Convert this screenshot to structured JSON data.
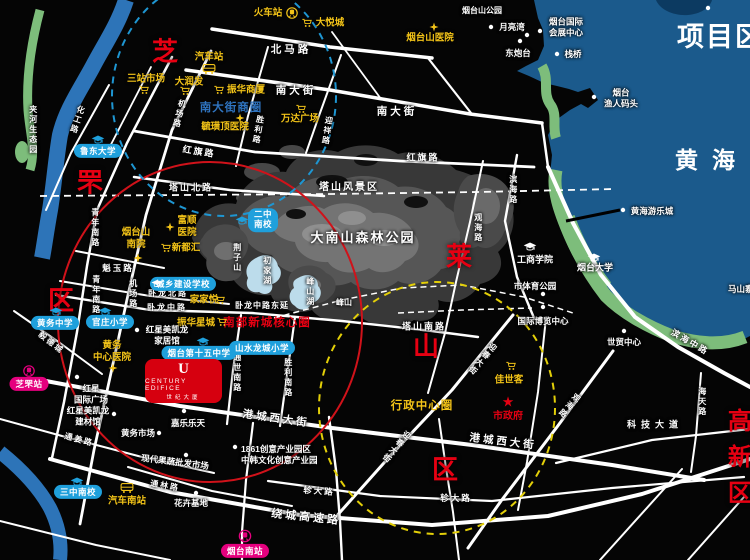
{
  "title": "项目区位",
  "sea_name": "黄海",
  "colors": {
    "sea": "#1b5a8c",
    "accent_red": "#e60012",
    "poi_yellow": "#f2c318",
    "school_blue": "#1fa0dc",
    "station_pink": "#e5007e"
  },
  "districts": {
    "zhi": "芝",
    "fu": "罘",
    "qu_zhifu": "区",
    "lai": "莱",
    "shan": "山",
    "qu_laishan": "区",
    "gaoxinqu": "高新区"
  },
  "zones": {
    "nandajie_shangquan": "南大街商圈",
    "nanbu_xincheng": "南部新城核心圈",
    "xingzheng_zhongxin": "行政中心圈"
  },
  "nature": {
    "jiahe": "夹河生态园",
    "tashan_scenic": "塔山风景区",
    "dananshan": "大南山森林公园",
    "yantaishan_park": "烟台山公园",
    "jingzishan": "荆子山",
    "fengshan": "峰山",
    "chujia_lake": "初家湖",
    "fengshan_lake": "峰山湖"
  },
  "roads": {
    "beimalu": "北马路",
    "nandajie": "南大街",
    "hongqilu": "红旗路",
    "tashanbeilu": "塔山北路",
    "tashannanlu": "塔山南路",
    "kuiyulu": "魁玉路",
    "wolongbeilu": "卧龙北路",
    "wolongzhonglu": "卧龙中路",
    "wolong_dongyan": "卧龙中路东延",
    "huagonglu": "化工路",
    "jichanglu": "机场路",
    "qingniannanlu": "青年南路",
    "shenglilu": "胜利路",
    "yingxianglu": "迎祥路",
    "tongshinanlu": "通世南路",
    "shenglinanlu": "胜利南路",
    "binhailu": "滨海路",
    "guanhailu": "观海路",
    "binhaizhonglu": "滨海中路",
    "haitianlu": "海天路",
    "kejidadao": "科技大道",
    "gangchengxidajie": "港城西大街",
    "raocheng": "绕城高速路",
    "zhendalu": "轸大路",
    "yingchundajie": "迎春大街",
    "tonglinlu": "通林路",
    "tongjianglu": "通姜路",
    "yidecheng": "毅德城"
  },
  "stations": {
    "huochezhan": "火车站",
    "qichezhan": "汽车站",
    "zhifuzhan": "芝罘站",
    "qichenanzhan": "汽车南站",
    "yantainanzhan": "烟台南站"
  },
  "pois": {
    "dayuecheng": "大悦城",
    "sanzhanshichang": "三站市场",
    "darunfa": "大润发",
    "zhenhuashangsha": "振华商厦",
    "wandaguangchang": "万达广场",
    "yuhuangding": "毓璜顶医院",
    "yantaishanyiyuan": "烟台山医院",
    "yueliangwan": "月亮湾",
    "dongpaotai": "东炮台",
    "huizhan1": "烟台国际",
    "huizhan2": "会展中心",
    "zhanqiao": "栈桥",
    "yuren1": "烟台",
    "yuren2": "渔人码头",
    "ludong": "鲁东大学",
    "fushun1": "富顺",
    "fushun2": "医院",
    "nanyuan1": "烟台山",
    "nanyuan2": "南院",
    "xinduhui": "新都汇",
    "erzhong1": "二中",
    "erzhong2": "南校",
    "chengxiang": "城乡建设学校",
    "jiajiayue": "家家悦",
    "zhenhuaxingcheng": "振华星城",
    "hongxing_jiaju1": "红星美凯龙",
    "hongxing_jiaju2": "家居馆",
    "shiwuzhong": "烟台第十五中学",
    "shanshui": "山水龙城小学",
    "huangwuzhongxue": "黄务中学",
    "guanzhuang": "官庄小学",
    "huangwuyiyuan1": "黄务",
    "huangwuyiyuan2": "中心医院",
    "hongxing_guoji1": "红星",
    "hongxing_guoji2": "国际广场",
    "hongxing_jiancai1": "红星美凯龙",
    "hongxing_jiancai2": "建材馆",
    "sanzhongnanxiao": "三中南校",
    "huangwushichang": "黄务市场",
    "jialeletian": "嘉乐乐天",
    "guoshu": "现代果蔬批发市场",
    "huahuijidi": "花卉基地",
    "chanyeyuan1": "1861创意产业园区",
    "chanyeyuan2": "中韩文化创意产业园",
    "jiashike": "佳世客",
    "shizhengfu": "市政府",
    "gongshang": "工商学院",
    "yantaidaxue": "烟台大学",
    "shitiyu": "市体育公园",
    "guojibolan": "国际博览中心",
    "shimao": "世贸中心",
    "huanghaiyoule": "黄海游乐城",
    "mashan": "马山寨"
  },
  "logo": {
    "emblem": "U",
    "en": "CENTURY EDIFICE",
    "cn": "世纪大厦"
  }
}
